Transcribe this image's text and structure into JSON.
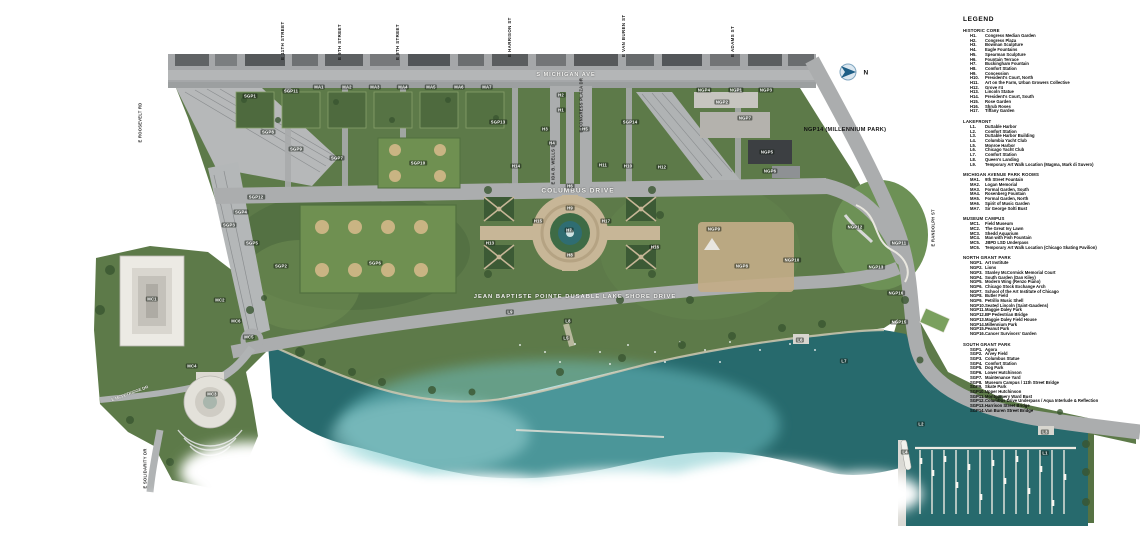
{
  "legend": {
    "title": "LEGEND",
    "sections": [
      {
        "heading": "HISTORIC CORE",
        "items": [
          {
            "c": "H1.",
            "n": "Congress Median Garden"
          },
          {
            "c": "H2.",
            "n": "Congress Plaza"
          },
          {
            "c": "H3.",
            "n": "Bowman Sculpture"
          },
          {
            "c": "H4.",
            "n": "Eagle Fountains"
          },
          {
            "c": "H5.",
            "n": "Spearman Sculpture"
          },
          {
            "c": "H6.",
            "n": "Fountain Terrace"
          },
          {
            "c": "H7.",
            "n": "Buckingham Fountain"
          },
          {
            "c": "H8.",
            "n": "Comfort Station"
          },
          {
            "c": "H9.",
            "n": "Concession"
          },
          {
            "c": "H10.",
            "n": "President's Court, North"
          },
          {
            "c": "H11.",
            "n": "Art on the Farm, Urban Growers Collective"
          },
          {
            "c": "H12.",
            "n": "Grove #4"
          },
          {
            "c": "H13.",
            "n": "Lincoln Statue"
          },
          {
            "c": "H14.",
            "n": "President's Court, South"
          },
          {
            "c": "H15.",
            "n": "Rose Garden"
          },
          {
            "c": "H16.",
            "n": "Shrub Roses"
          },
          {
            "c": "H17.",
            "n": "Tiffany Garden"
          }
        ]
      },
      {
        "heading": "LAKEFRONT",
        "items": [
          {
            "c": "L1.",
            "n": "DuSable Harbor"
          },
          {
            "c": "L2.",
            "n": "Comfort Station"
          },
          {
            "c": "L3.",
            "n": "DuSable Harbor Building"
          },
          {
            "c": "L4.",
            "n": "Columbia Yacht Club"
          },
          {
            "c": "L5.",
            "n": "Monroe Harbor"
          },
          {
            "c": "L6.",
            "n": "Chicago Yacht Club"
          },
          {
            "c": "L7.",
            "n": "Comfort Station"
          },
          {
            "c": "L8.",
            "n": "Queen's Landing"
          },
          {
            "c": "L9.",
            "n": "Temporary Art Walk Location (Magma, Mark di Suvero)"
          }
        ]
      },
      {
        "heading": "MICHIGAN AVENUE PARK ROOMS",
        "items": [
          {
            "c": "MA1.",
            "n": "9th Street Fountain"
          },
          {
            "c": "MA2.",
            "n": "Logan Memorial"
          },
          {
            "c": "MA3.",
            "n": "Formal Garden, South"
          },
          {
            "c": "MA4.",
            "n": "Rosenberg Fountain"
          },
          {
            "c": "MA5.",
            "n": "Formal Garden, North"
          },
          {
            "c": "MA6.",
            "n": "Spirit of Music Garden"
          },
          {
            "c": "MA7.",
            "n": "Sir George Solti Bust"
          }
        ]
      },
      {
        "heading": "MUSEUM CAMPUS",
        "items": [
          {
            "c": "MC1.",
            "n": "Field Museum"
          },
          {
            "c": "MC2.",
            "n": "The Great Ivy Lawn"
          },
          {
            "c": "MC3.",
            "n": "Shedd Aquarium"
          },
          {
            "c": "MC4.",
            "n": "Man with Fish Fountain"
          },
          {
            "c": "MC5.",
            "n": "JBPD LSD Underpass"
          },
          {
            "c": "MC6.",
            "n": "Temporary Art Walk Location (Chicago Skating Pavilion)"
          }
        ]
      },
      {
        "heading": "NORTH GRANT PARK",
        "items": [
          {
            "c": "NGP1.",
            "n": "Art Institute"
          },
          {
            "c": "NGP2.",
            "n": "Lions"
          },
          {
            "c": "NGP3.",
            "n": "Stanley McCormick Memorial Court"
          },
          {
            "c": "NGP4.",
            "n": "South Garden (Dan Kiley)"
          },
          {
            "c": "NGP5.",
            "n": "Modern Wing (Renzo Piano)"
          },
          {
            "c": "NGP6.",
            "n": "Chicago Stock Exchange Arch"
          },
          {
            "c": "NGP7.",
            "n": "School of the Art Institute of Chicago"
          },
          {
            "c": "NGP8.",
            "n": "Butler Field"
          },
          {
            "c": "NGP9.",
            "n": "Petrillo Music Shell"
          },
          {
            "c": "NGP10.",
            "n": "Seated Lincoln (Saint-Gaudens)"
          },
          {
            "c": "NGP11.",
            "n": "Maggie Daley Park"
          },
          {
            "c": "NGP12.",
            "n": "BP Pedestrian Bridge"
          },
          {
            "c": "NGP13.",
            "n": "Maggie Daley Field House"
          },
          {
            "c": "NGP14.",
            "n": "Millennium Park"
          },
          {
            "c": "NGP15.",
            "n": "Peanut Park"
          },
          {
            "c": "NGP16.",
            "n": "Cancer Survivors' Garden"
          }
        ]
      },
      {
        "heading": "SOUTH GRANT PARK",
        "items": [
          {
            "c": "SGP1.",
            "n": "Agora"
          },
          {
            "c": "SGP2.",
            "n": "Arvey Field"
          },
          {
            "c": "SGP3.",
            "n": "Columbus Statue"
          },
          {
            "c": "SGP4.",
            "n": "Comfort Station"
          },
          {
            "c": "SGP5.",
            "n": "Dog Park"
          },
          {
            "c": "SGP6.",
            "n": "Lower Hutchinson"
          },
          {
            "c": "SGP7.",
            "n": "Maintenance Yard"
          },
          {
            "c": "SGP8.",
            "n": "Museum Campus / 11th Street Bridge"
          },
          {
            "c": "SGP9.",
            "n": "Skate Park"
          },
          {
            "c": "SGP10.",
            "n": "Upper Hutchinson"
          },
          {
            "c": "SGP11.",
            "n": "Montgomery Ward Bust"
          },
          {
            "c": "SGP12.",
            "n": "Columbus Drive Underpass / Aqua Interlude & Reflection"
          },
          {
            "c": "SGP13.",
            "n": "Harrison Street Bridge"
          },
          {
            "c": "SGP14.",
            "n": "Van Buren Street Bridge"
          }
        ]
      }
    ]
  },
  "map": {
    "labels": [
      {
        "t": "E 11TH STREET",
        "x": 286,
        "y": 55,
        "k": "street"
      },
      {
        "t": "E 9TH STREET",
        "x": 343,
        "y": 55,
        "k": "street"
      },
      {
        "t": "E 8TH STREET",
        "x": 401,
        "y": 55,
        "k": "street"
      },
      {
        "t": "E HARRISON ST",
        "x": 513,
        "y": 52,
        "k": "street"
      },
      {
        "t": "E VAN BUREN ST",
        "x": 627,
        "y": 52,
        "k": "street"
      },
      {
        "t": "E ADAMS ST",
        "x": 736,
        "y": 52,
        "k": "street"
      },
      {
        "t": "E IDA B. WELLS DR",
        "x": 556,
        "y": 180,
        "k": "roadv"
      },
      {
        "t": "E CONGRESS PLAZA DR",
        "x": 584,
        "y": 128,
        "k": "roadv"
      },
      {
        "t": "E ROOSEVELT RD",
        "x": 143,
        "y": 138,
        "k": "roadv"
      },
      {
        "t": "E RANDOLPH ST",
        "x": 936,
        "y": 242,
        "k": "roadv"
      },
      {
        "t": "E SOLIDARITY DR",
        "x": 148,
        "y": 484,
        "k": "roadv"
      },
      {
        "t": "S MICHIGAN AVE",
        "x": 566,
        "y": 75,
        "k": "road",
        "s": 5.5
      },
      {
        "t": "COLUMBUS DRIVE",
        "x": 578,
        "y": 191,
        "k": "road",
        "s": 6.5
      },
      {
        "t": "JEAN BAPTISTE POINTE DUSABLE LAKE SHORE DRIVE",
        "x": 575,
        "y": 297,
        "k": "road",
        "s": 5.8
      },
      {
        "t": "E MCFETRIDGE DR",
        "x": 130,
        "y": 394,
        "k": "diag"
      },
      {
        "t": "NGP14 (MILLENNIUM PARK)",
        "x": 845,
        "y": 130,
        "k": "note"
      },
      {
        "t": "N",
        "x": 866,
        "y": 73,
        "k": "note",
        "s": 6.5
      },
      {
        "t": "SGP1",
        "x": 250,
        "y": 96,
        "k": "zone"
      },
      {
        "t": "SGP11",
        "x": 291,
        "y": 91,
        "k": "zone"
      },
      {
        "t": "MA1",
        "x": 319,
        "y": 87,
        "k": "zone"
      },
      {
        "t": "MA2",
        "x": 347,
        "y": 87,
        "k": "zone"
      },
      {
        "t": "MA3",
        "x": 375,
        "y": 87,
        "k": "zone"
      },
      {
        "t": "MA4",
        "x": 403,
        "y": 87,
        "k": "zone"
      },
      {
        "t": "MA5",
        "x": 431,
        "y": 87,
        "k": "zone"
      },
      {
        "t": "MA6",
        "x": 459,
        "y": 87,
        "k": "zone"
      },
      {
        "t": "MA7",
        "x": 487,
        "y": 87,
        "k": "zone"
      },
      {
        "t": "SGP8",
        "x": 268,
        "y": 132,
        "k": "zone"
      },
      {
        "t": "SGP9",
        "x": 296,
        "y": 149,
        "k": "zone"
      },
      {
        "t": "SGP7",
        "x": 337,
        "y": 158,
        "k": "zone"
      },
      {
        "t": "SGP10",
        "x": 418,
        "y": 163,
        "k": "zone"
      },
      {
        "t": "SGP13",
        "x": 498,
        "y": 122,
        "k": "zone"
      },
      {
        "t": "SGP14",
        "x": 630,
        "y": 122,
        "k": "zone"
      },
      {
        "t": "SGP12",
        "x": 256,
        "y": 197,
        "k": "zone"
      },
      {
        "t": "SGP4",
        "x": 241,
        "y": 212,
        "k": "zone"
      },
      {
        "t": "SGP3",
        "x": 229,
        "y": 225,
        "k": "zone"
      },
      {
        "t": "SGP5",
        "x": 252,
        "y": 243,
        "k": "zone"
      },
      {
        "t": "SGP2",
        "x": 281,
        "y": 266,
        "k": "zone"
      },
      {
        "t": "SGP6",
        "x": 375,
        "y": 263,
        "k": "zone"
      },
      {
        "t": "H2",
        "x": 561,
        "y": 95,
        "k": "zone"
      },
      {
        "t": "H1",
        "x": 561,
        "y": 110,
        "k": "zone"
      },
      {
        "t": "H3",
        "x": 545,
        "y": 129,
        "k": "zone"
      },
      {
        "t": "H5",
        "x": 585,
        "y": 129,
        "k": "zone"
      },
      {
        "t": "H4",
        "x": 552,
        "y": 143,
        "k": "zone"
      },
      {
        "t": "H14",
        "x": 516,
        "y": 166,
        "k": "zone"
      },
      {
        "t": "H11",
        "x": 603,
        "y": 165,
        "k": "zone"
      },
      {
        "t": "H10",
        "x": 628,
        "y": 166,
        "k": "zone"
      },
      {
        "t": "H12",
        "x": 662,
        "y": 167,
        "k": "zone"
      },
      {
        "t": "H6",
        "x": 570,
        "y": 186,
        "k": "zone"
      },
      {
        "t": "H9",
        "x": 570,
        "y": 208,
        "k": "zone"
      },
      {
        "t": "H7",
        "x": 569,
        "y": 230,
        "k": "zone"
      },
      {
        "t": "H8",
        "x": 570,
        "y": 255,
        "k": "zone"
      },
      {
        "t": "H13",
        "x": 490,
        "y": 243,
        "k": "zone"
      },
      {
        "t": "H15",
        "x": 538,
        "y": 221,
        "k": "zone"
      },
      {
        "t": "H17",
        "x": 606,
        "y": 221,
        "k": "zone"
      },
      {
        "t": "H16",
        "x": 655,
        "y": 247,
        "k": "zone"
      },
      {
        "t": "NGP4",
        "x": 704,
        "y": 90,
        "k": "zone"
      },
      {
        "t": "NGP1",
        "x": 736,
        "y": 90,
        "k": "zone"
      },
      {
        "t": "NGP3",
        "x": 766,
        "y": 90,
        "k": "zone"
      },
      {
        "t": "NGP2",
        "x": 722,
        "y": 102,
        "k": "zone"
      },
      {
        "t": "NGP7",
        "x": 745,
        "y": 118,
        "k": "zone"
      },
      {
        "t": "NGP5",
        "x": 767,
        "y": 152,
        "k": "zone"
      },
      {
        "t": "NGP6",
        "x": 770,
        "y": 171,
        "k": "zone"
      },
      {
        "t": "NGP9",
        "x": 714,
        "y": 229,
        "k": "zone"
      },
      {
        "t": "NGP8",
        "x": 742,
        "y": 266,
        "k": "zone"
      },
      {
        "t": "NGP10",
        "x": 792,
        "y": 260,
        "k": "zone"
      },
      {
        "t": "NGP12",
        "x": 855,
        "y": 227,
        "k": "zone"
      },
      {
        "t": "NGP11",
        "x": 899,
        "y": 243,
        "k": "zone"
      },
      {
        "t": "NGP13",
        "x": 876,
        "y": 267,
        "k": "zone"
      },
      {
        "t": "NGP16",
        "x": 896,
        "y": 293,
        "k": "zone"
      },
      {
        "t": "NGP15",
        "x": 899,
        "y": 322,
        "k": "zone"
      },
      {
        "t": "MC1",
        "x": 152,
        "y": 299,
        "k": "zone"
      },
      {
        "t": "MC2",
        "x": 220,
        "y": 300,
        "k": "zone"
      },
      {
        "t": "MC6",
        "x": 236,
        "y": 321,
        "k": "zone"
      },
      {
        "t": "MC5",
        "x": 249,
        "y": 337,
        "k": "zone"
      },
      {
        "t": "MC4",
        "x": 192,
        "y": 366,
        "k": "zone"
      },
      {
        "t": "MC3",
        "x": 212,
        "y": 394,
        "k": "zone"
      },
      {
        "t": "L9",
        "x": 510,
        "y": 312,
        "k": "zone"
      },
      {
        "t": "L8",
        "x": 568,
        "y": 321,
        "k": "zone"
      },
      {
        "t": "L5",
        "x": 566,
        "y": 338,
        "k": "zone"
      },
      {
        "t": "L6",
        "x": 800,
        "y": 340,
        "k": "zone"
      },
      {
        "t": "L7",
        "x": 844,
        "y": 361,
        "k": "zone"
      },
      {
        "t": "L2",
        "x": 921,
        "y": 424,
        "k": "zone"
      },
      {
        "t": "L4",
        "x": 905,
        "y": 452,
        "k": "zone"
      },
      {
        "t": "L3",
        "x": 1045,
        "y": 432,
        "k": "zone"
      },
      {
        "t": "L1",
        "x": 1045,
        "y": 453,
        "k": "zone"
      }
    ]
  }
}
